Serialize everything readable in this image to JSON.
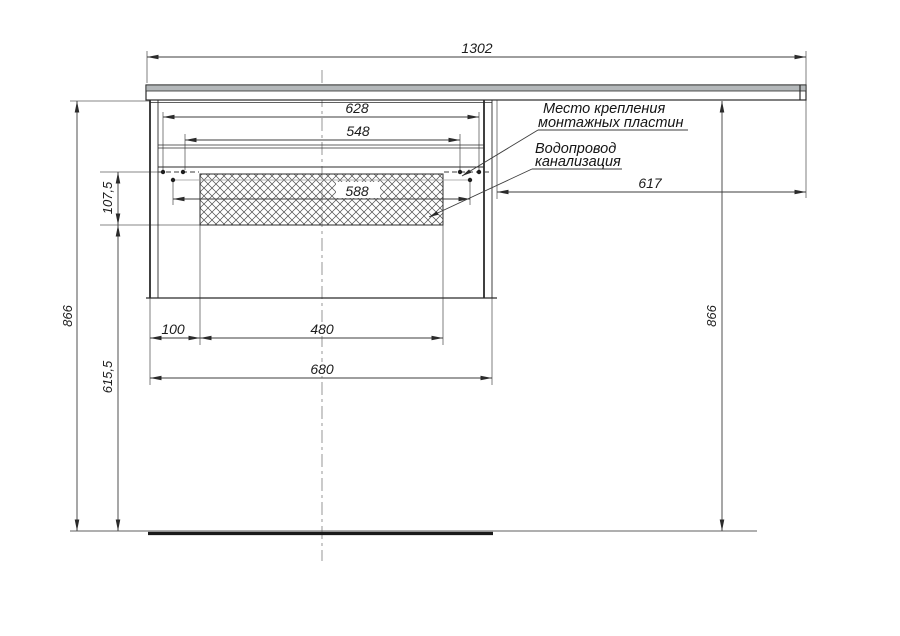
{
  "drawing": {
    "labels": {
      "mounting_line1": "Место крепления",
      "mounting_line2": "монтажных пластин",
      "plumbing_line1": "Водопровод",
      "plumbing_line2": "канализация"
    },
    "dimensions": {
      "countertop_width": "1302",
      "mount_outer_span": "628",
      "mount_inner_span": "548",
      "plumbing_zone_width": "588",
      "right_overhang": "617",
      "height_left": "866",
      "height_right": "866",
      "plumbing_zone_height": "107,5",
      "plumbing_zone_to_floor": "615,5",
      "left_inset": "100",
      "recess_width": "480",
      "cabinet_width": "680"
    },
    "colors": {
      "object_line": "#2b2b2b",
      "dimension_line": "#3c3c3c",
      "countertop_fill": "#b4b8ba",
      "background": "#ffffff"
    }
  }
}
